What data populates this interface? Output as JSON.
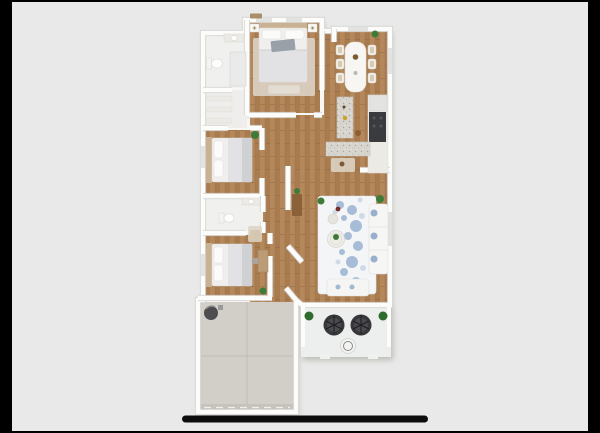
{
  "scene": {
    "type": "3d-floor-plan-rendering",
    "view": "top-down dollhouse",
    "background": "#000000",
    "photo_background": "#e8e9e8",
    "letterbox_bars": {
      "left_px": 12,
      "right_px": 12,
      "top_px": 2,
      "bottom_px": 2
    },
    "divider_line": {
      "color": "#0c0c0c",
      "x": 182,
      "y": 415.5,
      "width": 246,
      "height": 7
    }
  },
  "palette": {
    "wall": "#fcfcfb",
    "wallEdge": "#d0cfcb",
    "window": "#e2e3e1",
    "footprint": "#f7f7f5",
    "woodA": "#b5885c",
    "woodB": "#a97c50",
    "woodLine": "#8a6239",
    "tile": "#f0f0ee",
    "concrete": "#d2cfc9",
    "concreteSeam": "#b9b6af",
    "garageDoor": "#c6c3bc",
    "rug": "#f4f5f7",
    "rugBlue": "#7f9fc5",
    "rugBlueLight": "#b3c4da",
    "bedding": "#f0efed",
    "duvet": "#e2e2e5",
    "blanket": "#cfd1d4",
    "headboard": "#c9b294",
    "pillowGray": "#9aa0a8",
    "bench": "#e2dcd2",
    "counter": "#eceae5",
    "granite": "#d8d5cf",
    "appliance": "#3a3b3e",
    "plant": "#3f7b38",
    "plantDark": "#2f6b2d",
    "wicker": "#38383b",
    "wickerInner": "#4a4a4f",
    "tableWhite": "#f7f6f3",
    "furnWood": "#8a6138",
    "accentRed": "#7a2d2e",
    "accentYellow": "#c9a227",
    "bedroomRug": "#dcd3c6"
  },
  "rooms": [
    {
      "name": "primary-bedroom",
      "floor": "wood",
      "contents": [
        "bed",
        "two-nightstands",
        "lamps",
        "foot-bench",
        "area-rug"
      ]
    },
    {
      "name": "bathroom-top",
      "floor": "tile",
      "contents": [
        "toilet",
        "vanity",
        "shower"
      ]
    },
    {
      "name": "hall-closet",
      "floor": "tile",
      "contents": [
        "shelves"
      ]
    },
    {
      "name": "dining-room",
      "floor": "wood",
      "contents": [
        "dining-table",
        "six-chairs",
        "centerpiece",
        "plant"
      ]
    },
    {
      "name": "kitchen",
      "floor": "wood",
      "contents": [
        "island",
        "range",
        "refrigerator",
        "counter",
        "entry-rug",
        "stool"
      ]
    },
    {
      "name": "bedroom-2",
      "floor": "wood",
      "contents": [
        "bed",
        "plant"
      ]
    },
    {
      "name": "bathroom-middle",
      "floor": "tile",
      "contents": [
        "toilet",
        "vanity"
      ]
    },
    {
      "name": "bedroom-3",
      "floor": "wood",
      "contents": [
        "bed",
        "desk",
        "plant"
      ]
    },
    {
      "name": "hallway",
      "floor": "wood",
      "contents": [
        "console-table",
        "plant",
        "small-rug"
      ]
    },
    {
      "name": "living-room",
      "floor": "wood",
      "contents": [
        "floral-rug",
        "sofa",
        "loveseat-bench",
        "coffee-table",
        "side-table",
        "plants"
      ]
    },
    {
      "name": "patio",
      "floor": "concrete",
      "contents": [
        "wicker-chair",
        "wicker-chair",
        "round-table",
        "plants",
        "step-pads"
      ]
    },
    {
      "name": "garage",
      "floor": "concrete",
      "contents": [
        "water-heater",
        "garage-door"
      ]
    }
  ]
}
